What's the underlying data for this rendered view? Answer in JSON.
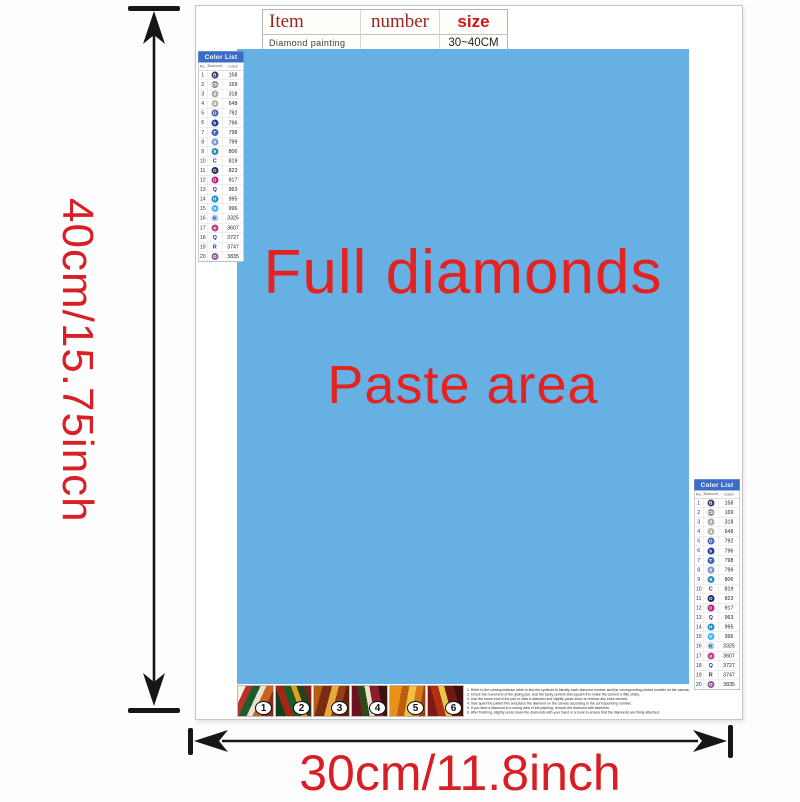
{
  "dimensions": {
    "height_label": "40cm/15.75inch",
    "width_label": "30cm/11.8inch"
  },
  "info_table": {
    "headers": [
      "Item",
      "number",
      "size"
    ],
    "row": {
      "item": "Diamond painting",
      "number": "",
      "size": "30~40CM"
    }
  },
  "paste_area": {
    "line1": "Full diamonds",
    "line2": "Paste area",
    "bg_color": "#66b0e4",
    "text_color": "#e42320"
  },
  "color_list": {
    "title": "Color List",
    "columns": [
      "No.",
      "Diamond",
      "Color"
    ],
    "rows": [
      {
        "no": "1",
        "symbol": "B",
        "style": "filled",
        "color": "#39406e",
        "code": "158"
      },
      {
        "no": "2",
        "symbol": "Cb",
        "style": "filled",
        "color": "#878c90",
        "code": "169"
      },
      {
        "no": "3",
        "symbol": "d",
        "style": "filled",
        "color": "#a7a9ac",
        "code": "318"
      },
      {
        "no": "4",
        "symbol": "4",
        "style": "filled",
        "color": "#b7b4ab",
        "code": "648"
      },
      {
        "no": "5",
        "symbol": "O",
        "style": "filled",
        "color": "#4f61ab",
        "code": "792"
      },
      {
        "no": "6",
        "symbol": "b",
        "style": "filled",
        "color": "#1f3e99",
        "code": "796"
      },
      {
        "no": "7",
        "symbol": "T",
        "style": "filled",
        "color": "#3c68b4",
        "code": "798"
      },
      {
        "no": "8",
        "symbol": "8",
        "style": "filled",
        "color": "#7b95cc",
        "code": "799"
      },
      {
        "no": "9",
        "symbol": "9",
        "style": "filled",
        "color": "#2d8fb4",
        "code": "806"
      },
      {
        "no": "10",
        "symbol": "C",
        "style": "plain",
        "color": "#22307a",
        "code": "819"
      },
      {
        "no": "11",
        "symbol": "O",
        "style": "filled",
        "color": "#1d2d5c",
        "code": "823"
      },
      {
        "no": "12",
        "symbol": "D",
        "style": "filled",
        "color": "#b02079",
        "code": "917"
      },
      {
        "no": "13",
        "symbol": "Q",
        "style": "plain",
        "color": "#22307a",
        "code": "963"
      },
      {
        "no": "14",
        "symbol": "H",
        "style": "filled",
        "color": "#1e8ec9",
        "code": "995"
      },
      {
        "no": "15",
        "symbol": "V",
        "style": "filled",
        "color": "#4cb6e8",
        "code": "996"
      },
      {
        "no": "16",
        "symbol": "K",
        "style": "light",
        "color": "#aeccea",
        "code": "3325"
      },
      {
        "no": "17",
        "symbol": "e",
        "style": "filled",
        "color": "#c04288",
        "code": "3607"
      },
      {
        "no": "18",
        "symbol": "Q",
        "style": "plain",
        "color": "#22307a",
        "code": "3727"
      },
      {
        "no": "19",
        "symbol": "R",
        "style": "plain",
        "color": "#22307a",
        "code": "3747"
      },
      {
        "no": "20",
        "symbol": "O",
        "style": "filled",
        "color": "#8d5f99",
        "code": "3835"
      }
    ]
  },
  "steps": [
    "1",
    "2",
    "3",
    "4",
    "5",
    "6"
  ],
  "instructions": {
    "lines": [
      "1. Refer to the correspondence table to find the symbols to identify each diamond number and the corresponding printed number on the canvas.",
      "2. Check the round end of the gluing pen, tear the tacky cement and squash it to make the cement a little sticky.",
      "3. Use the round end of the pen to stick a diamond and slightly press down to remove any extra cement.",
      "4. Tear apart the parted film and place the diamond on the canvas according to the corresponding number.",
      "5. If you stick a diamond in a wrong area of the painting, remove the diamond with tweezers.",
      "6. After finishing, slightly press down the diamonds with your hand or a book to ensure that the diamonds are firmly attached."
    ]
  },
  "colors": {
    "paste_blue": "#66b0e4",
    "label_red": "#d81f26",
    "title_red": "#e42320",
    "table_header_maroon": "#9e2222",
    "table_size_red": "#cc1518",
    "list_header_blue": "#3b6cc7",
    "arrow_black": "#161616"
  }
}
